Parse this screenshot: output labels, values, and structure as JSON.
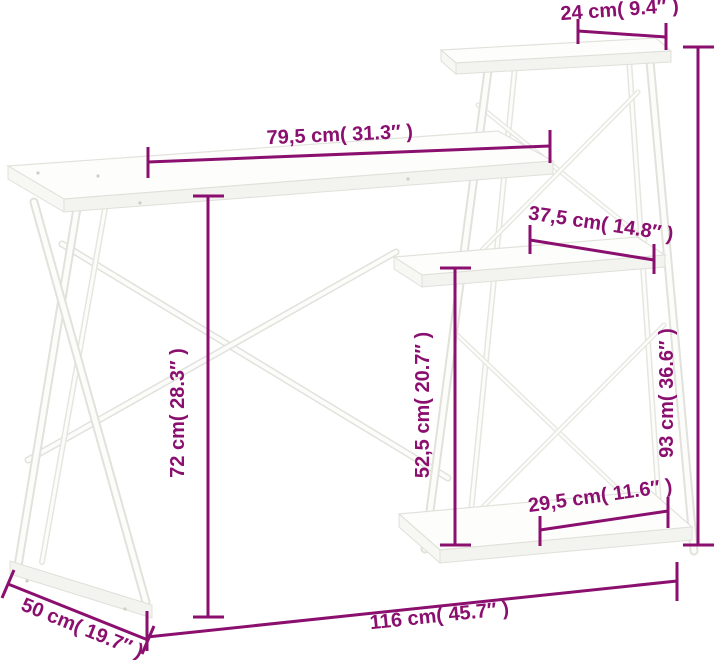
{
  "diagram": {
    "type": "product-dimension-diagram",
    "subject": "desk with shelf unit, white, line drawing",
    "background_color": "#ffffff",
    "dimension_color": "#8A0F6E",
    "furniture_fill": "#fcfcfa",
    "furniture_outline": "#e2e2dc",
    "dimensions": {
      "top_shelf_width": "24 cm( 9.4″ )",
      "desktop_width": "79,5 cm( 31.3″ )",
      "middle_shelf_width": "37,5 cm( 14.8″ )",
      "overall_height": "93 cm( 36.6″ )",
      "desktop_height": "72 cm( 28.3″ )",
      "shelf_column_height": "52,5 cm( 20.7″ )",
      "bottom_shelf_width": "29,5 cm( 11.6″ )",
      "overall_width": "116 cm( 45.7″ )",
      "depth": "50 cm( 19.7″ )"
    }
  }
}
